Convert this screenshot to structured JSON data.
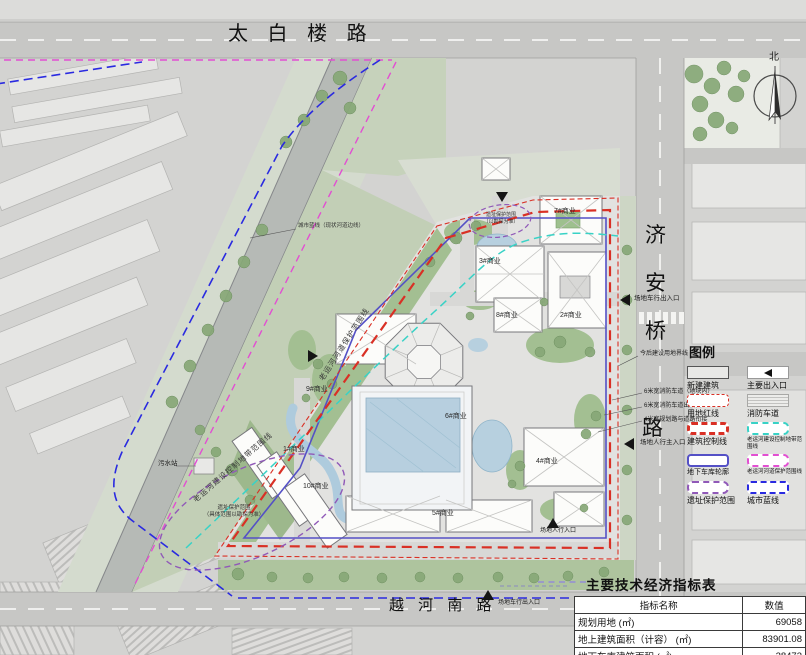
{
  "plan": {
    "roads": {
      "top": "太 白 楼 路",
      "right_chars": [
        "济",
        "安",
        "桥",
        "路"
      ],
      "bottom": "越 河 南 路"
    },
    "north_label": "北"
  },
  "buildings": [
    {
      "label": "7#商业"
    },
    {
      "label": "3#商业"
    },
    {
      "label": "2#商业"
    },
    {
      "label": "8#商业"
    },
    {
      "label": "9#商业"
    },
    {
      "label": "6#商业"
    },
    {
      "label": "4#商业"
    },
    {
      "label": "5#商业"
    },
    {
      "label": "10#商业"
    },
    {
      "label": "1#商业"
    }
  ],
  "annotations": {
    "vehicle_entrance_right": "场地车行出入口",
    "pedestrian_main_entrance": "场地人行主入口",
    "vehicle_entrance_bottom": "场地车行出入口",
    "pedestrian_entrance_inner": "场地人行入口",
    "sewage_station": "污水站",
    "future_plot_note": "今后建设用地界线",
    "fire_lane_note_1": "6米宽消防车道（地块内）",
    "fire_lane_note_2": "6米宽消防车道出入口",
    "fire_lane_note_3": "4米宽规划路与道路衔接",
    "city_blue_line_note": "城市蓝线（现状河道边线）",
    "heritage_area_note_1": "遗址保护范围",
    "heritage_area_note_2": "（具体范围以勘探为准）",
    "heritage_spot_note_1": "遗址保护范围",
    "heritage_spot_note_2": "（以勘探为准）",
    "canal_construction_control_line": "老运河建设控制地带范围线",
    "canal_channel_protection_line": "老运河河道保护范围线"
  },
  "legend": {
    "title": "图例",
    "items": [
      {
        "label": "新建建筑"
      },
      {
        "label": "主要出入口"
      },
      {
        "label": "用地红线"
      },
      {
        "label": "消防车道"
      },
      {
        "label": "建筑控制线"
      },
      {
        "label": "老运河建设控制地带范围线"
      },
      {
        "label": "地下车库轮廓"
      },
      {
        "label": "老运河河道保护范围线"
      },
      {
        "label": "遗址保护范围"
      },
      {
        "label": "城市蓝线"
      }
    ]
  },
  "table": {
    "title": "主要技术经济指标表",
    "headers": [
      "指标名称",
      "数值"
    ],
    "rows": [
      {
        "name": "规划用地 (㎡)",
        "value": "69058"
      },
      {
        "name": "地上建筑面积（计容） (㎡)",
        "value": "83901.08"
      },
      {
        "name": "地下车库建筑面积 (㎡)",
        "value": "28473"
      }
    ]
  },
  "colors": {
    "site_red_line": "#d93025",
    "canal_construction_cyan": "#38d2c6",
    "canal_protection_magenta": "#e24fd2",
    "garage_blue": "#5450c6",
    "heritage_purple": "#9059b8",
    "city_blue": "#2a2ae0"
  }
}
